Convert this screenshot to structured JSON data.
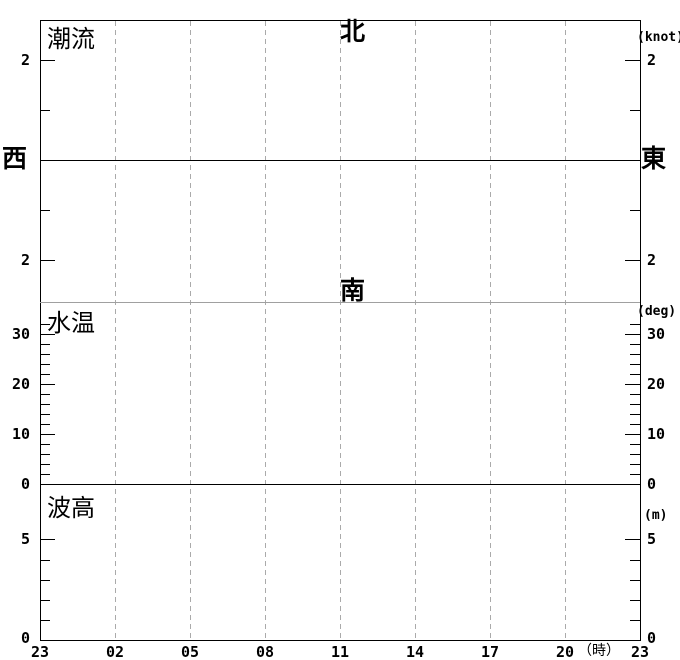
{
  "colors": {
    "background": "#ffffff",
    "axis": "#000000",
    "grid_dashed": "#aaaaaa",
    "section_divider": "#a0a0a0"
  },
  "panels": {
    "current": {
      "label": "潮流",
      "unit": "(knot)",
      "direction_north": "北",
      "direction_south": "南",
      "direction_west": "西",
      "direction_east": "東",
      "tick_upper": "2",
      "tick_lower": "2"
    },
    "temperature": {
      "label": "水温",
      "unit": "(deg)",
      "ticks": [
        "30",
        "20",
        "10",
        "0"
      ]
    },
    "wave": {
      "label": "波高",
      "unit": "(m)",
      "ticks": [
        "5",
        "0"
      ]
    }
  },
  "x_axis": {
    "labels": [
      "23",
      "02",
      "05",
      "08",
      "11",
      "14",
      "17",
      "20",
      "23"
    ],
    "unit": "（時）"
  },
  "chart_data": [
    {
      "type": "line",
      "title": "潮流",
      "ylabel": "(knot)",
      "xlabel": "時",
      "x_ticks": [
        "23",
        "02",
        "05",
        "08",
        "11",
        "14",
        "17",
        "20",
        "23"
      ],
      "x_tick_interval_hours": 3,
      "ylim": [
        -2.8,
        2.8
      ],
      "y_ticks": [
        -2,
        -1,
        0,
        1,
        2
      ],
      "y_tick_labels_shown": [
        "2",
        "2"
      ],
      "direction_axis": {
        "positive": "北",
        "negative": "南",
        "zero_left": "西",
        "zero_right": "東"
      },
      "grid": true,
      "legend": "none",
      "series": []
    },
    {
      "type": "line",
      "title": "水温",
      "ylabel": "(deg)",
      "xlabel": "時",
      "x_ticks": [
        "23",
        "02",
        "05",
        "08",
        "11",
        "14",
        "17",
        "20",
        "23"
      ],
      "ylim": [
        0,
        36.4
      ],
      "y_ticks": [
        0,
        10,
        20,
        30
      ],
      "y_minor_tick_step": 2,
      "grid": true,
      "legend": "none",
      "series": []
    },
    {
      "type": "line",
      "title": "波高",
      "ylabel": "(m)",
      "xlabel": "時",
      "x_ticks": [
        "23",
        "02",
        "05",
        "08",
        "11",
        "14",
        "17",
        "20",
        "23"
      ],
      "ylim": [
        0,
        7.7
      ],
      "y_ticks": [
        0,
        5
      ],
      "y_minor_tick_step": 1,
      "grid": true,
      "legend": "none",
      "series": []
    }
  ]
}
